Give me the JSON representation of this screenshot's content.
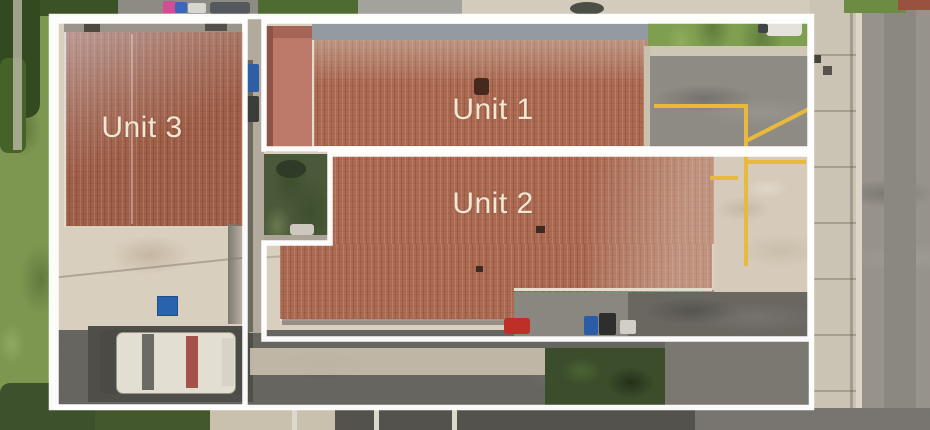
{
  "annotations": {
    "units": [
      {
        "id": "unit-1",
        "label": "Unit 1"
      },
      {
        "id": "unit-2",
        "label": "Unit 2"
      },
      {
        "id": "unit-3",
        "label": "Unit 3"
      }
    ],
    "outline_color": "#ffffff",
    "label_color": "#f2e7d3"
  },
  "scene": {
    "parking_line_color": "#e7b93c",
    "roof_color": "#ac6a52",
    "lawn_color": "#7d9750",
    "driveway_color": "#d7cdbc",
    "road_color": "#97938b"
  }
}
